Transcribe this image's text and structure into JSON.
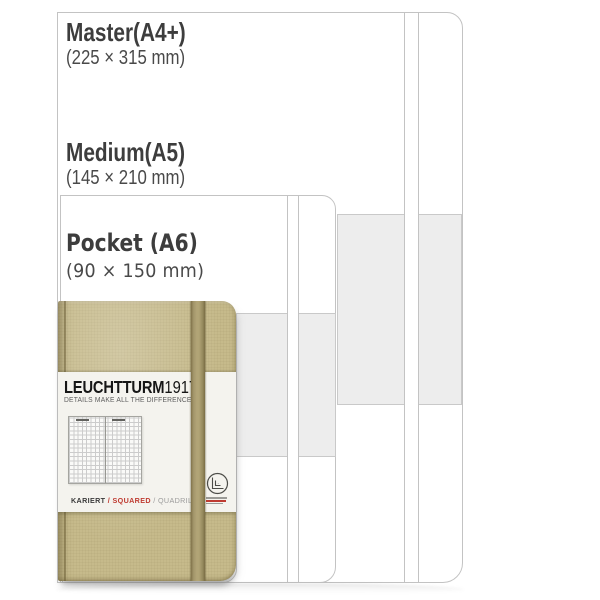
{
  "figure": {
    "description": "Notebook size comparison with nested cover outlines and pocket notebook product photo"
  },
  "sizes": [
    {
      "name": "Master(A4+)",
      "dimensions": "(225 × 315 mm)"
    },
    {
      "name": "Medium(A5)",
      "dimensions": "(145 × 210 mm)"
    },
    {
      "name": "Pocket (A6)",
      "dimensions": "(90 × 150 mm)"
    }
  ],
  "product_label": {
    "brand_main": "LEUCHTTURM",
    "brand_year": "1917",
    "tagline": "DETAILS MAKE ALL THE DIFFERENCE.",
    "ruling_de": "KARIERT",
    "ruling_sep": "/",
    "ruling_en": "SQUARED",
    "ruling_fr": "QUADRILLÉ"
  },
  "colors": {
    "cover": "#c6ba8b",
    "elastic_center": "#b2a577",
    "elastic_edge": "#82744b",
    "label_bg": "#f4f3ee",
    "outline_stroke": "#c3c3c3",
    "panel_gray": "#ededed",
    "accent_red": "#bf3b31",
    "heading_text": "#3d3d3d",
    "brand_black": "#161616",
    "tagline_gray": "#5d5d5d",
    "ruling_gray": "#9b9b9b"
  }
}
